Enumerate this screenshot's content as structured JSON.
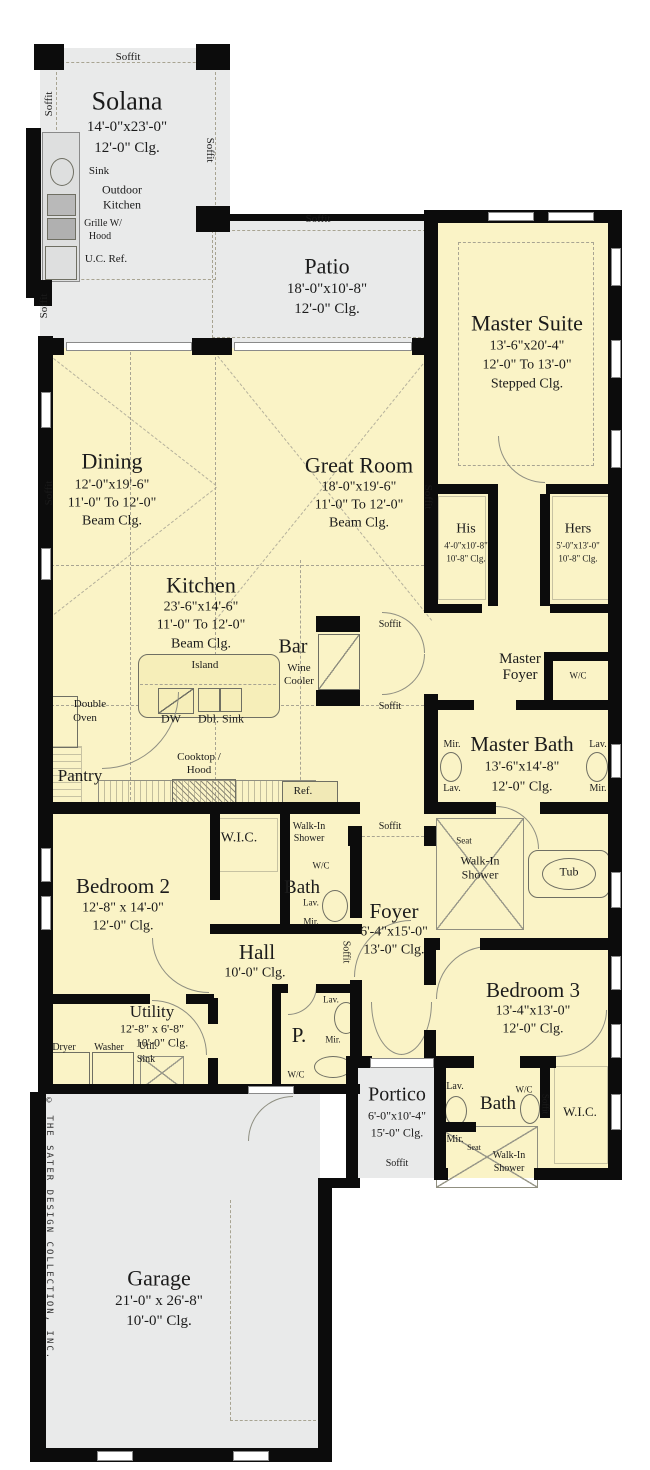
{
  "colors": {
    "interior": "#faf3c6",
    "outdoor": "#e9eaea",
    "wall": "#0c0c0c"
  },
  "rooms": {
    "solana": {
      "title": "Solana",
      "dims": "14'-0\"x23'-0\"",
      "clg": "12'-0\" Clg."
    },
    "patio": {
      "title": "Patio",
      "dims": "18'-0\"x10'-8\"",
      "clg": "12'-0\" Clg."
    },
    "master_suite": {
      "title": "Master Suite",
      "dims": "13'-6\"x20'-4\"",
      "clg1": "12'-0\" To 13'-0\"",
      "clg2": "Stepped Clg."
    },
    "dining": {
      "title": "Dining",
      "dims": "12'-0\"x19'-6\"",
      "clg1": "11'-0\" To 12'-0\"",
      "clg2": "Beam Clg."
    },
    "great_room": {
      "title": "Great Room",
      "dims": "18'-0\"x19'-6\"",
      "clg1": "11'-0\" To 12'-0\"",
      "clg2": "Beam Clg."
    },
    "kitchen": {
      "title": "Kitchen",
      "dims": "23'-6\"x14'-6\"",
      "clg1": "11'-0\" To 12'-0\"",
      "clg2": "Beam Clg."
    },
    "his": {
      "title": "His",
      "dims": "4'-0\"x10'-8\"",
      "clg": "10'-8\" Clg."
    },
    "hers": {
      "title": "Hers",
      "dims": "5'-0\"x13'-0\"",
      "clg": "10'-8\" Clg."
    },
    "master_foyer": {
      "line1": "Master",
      "line2": "Foyer"
    },
    "master_bath": {
      "title": "Master Bath",
      "dims": "13'-6\"x14'-8\"",
      "clg": "12'-0\" Clg."
    },
    "bedroom2": {
      "title": "Bedroom 2",
      "dims": "12'-8\" x 14'-0\"",
      "clg": "12'-0\" Clg."
    },
    "bath2": {
      "title": "Bath"
    },
    "foyer": {
      "title": "Foyer",
      "dims": "6'-4\"x15'-0\"",
      "clg": "13'-0\" Clg."
    },
    "hall": {
      "title": "Hall",
      "clg": "10'-0\" Clg."
    },
    "utility": {
      "title": "Utility",
      "dims": "12'-8\" x 6'-8\"",
      "clg": "10'-0\" Clg."
    },
    "powder": {
      "title": "P."
    },
    "bedroom3": {
      "title": "Bedroom 3",
      "dims": "13'-4\"x13'-0\"",
      "clg": "12'-0\" Clg."
    },
    "bath3": {
      "title": "Bath"
    },
    "wic2": {
      "title": "W.I.C."
    },
    "wic3": {
      "title": "W.I.C."
    },
    "portico": {
      "title": "Portico",
      "dims": "6'-0\"x10'-4\"",
      "clg": "15'-0\" Clg."
    },
    "garage": {
      "title": "Garage",
      "dims": "21'-0\" x 26'-8\"",
      "clg": "10'-0\" Clg."
    }
  },
  "labels": {
    "soffit": "Soffit",
    "sink": "Sink",
    "outdoor_kitchen1": "Outdoor",
    "outdoor_kitchen2": "Kitchen",
    "grille1": "Grille W/",
    "grille2": "Hood",
    "uc_ref": "U.C. Ref.",
    "island": "Island",
    "dw": "DW",
    "dbl_sink": "Dbl. Sink",
    "bar": "Bar",
    "wine1": "Wine",
    "wine2": "Cooler",
    "double_oven1": "Double",
    "double_oven2": "Oven",
    "pantry": "Pantry",
    "cooktop1": "Cooktop /",
    "cooktop2": "Hood",
    "ref": "Ref.",
    "walk_in": "Walk-In",
    "shower": "Shower",
    "wc": "W/C",
    "lav": "Lav.",
    "mir": "Mir.",
    "seat": "Seat",
    "tub": "Tub",
    "dryer": "Dryer",
    "washer": "Washer",
    "util": "Util.",
    "sink2": "Sink"
  },
  "copyright": "© THE SATER DESIGN COLLECTION, INC."
}
